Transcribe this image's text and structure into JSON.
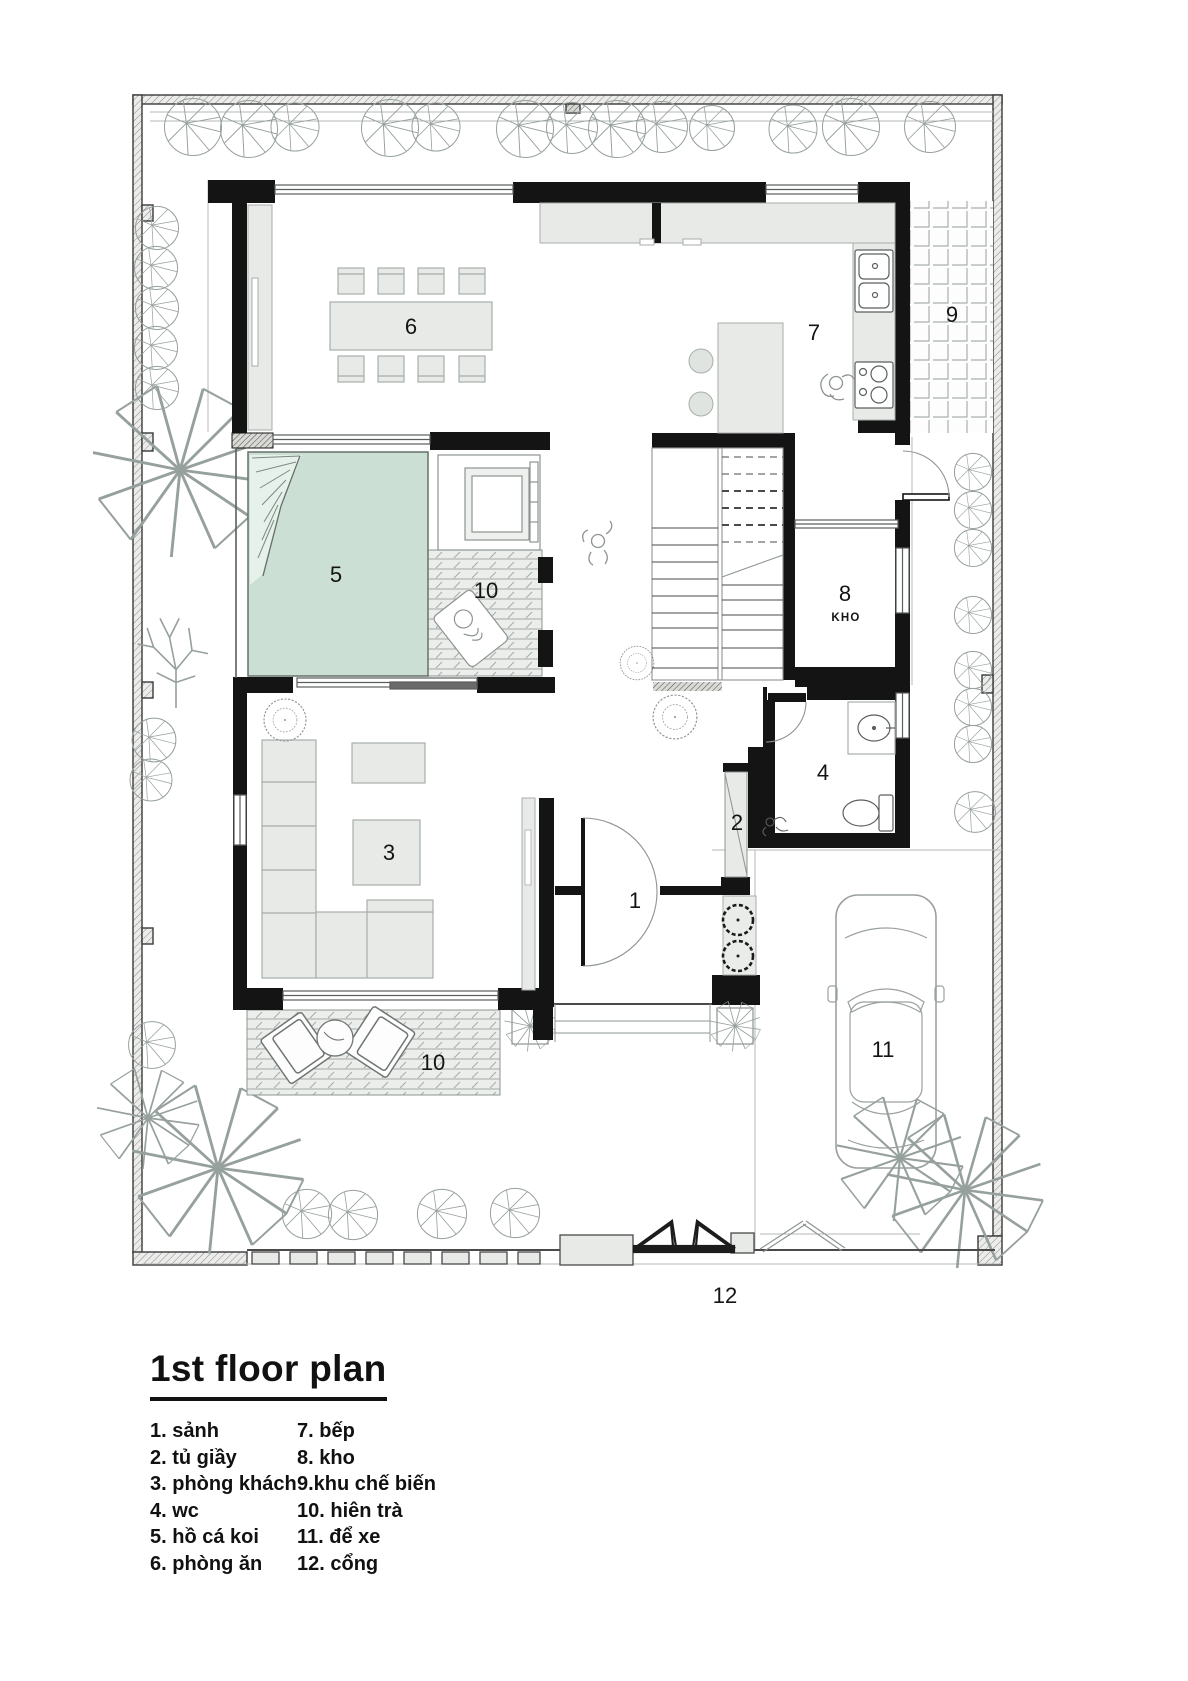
{
  "title": "1st floor plan",
  "legend": {
    "col1": [
      "1. sảnh",
      "2. tủ giầy",
      "3. phòng khách",
      "4. wc",
      "5. hồ cá koi",
      "6. phòng ăn"
    ],
    "col2": [
      "7. bếp",
      "8. kho",
      "9.khu chế biến",
      "10. hiên trà",
      "11. để xe",
      "12. cổng"
    ]
  },
  "labels": {
    "hall": "1",
    "shoe_cabinet": "2",
    "living_room": "3",
    "wc": "4",
    "koi_pond": "5",
    "dining_room": "6",
    "kitchen": "7",
    "storage": "8",
    "storage_name": "KHO",
    "prep_area": "9",
    "tea_deck_upper": "10",
    "tea_deck_lower": "10",
    "parking": "11",
    "gate": "12"
  },
  "colors": {
    "wall": "#141414",
    "pond_fill": "#cbdfd4",
    "furniture_fill": "#e7eae6",
    "boundary_fill": "#ececea",
    "line_gray": "#8d9492",
    "text": "#111111"
  }
}
